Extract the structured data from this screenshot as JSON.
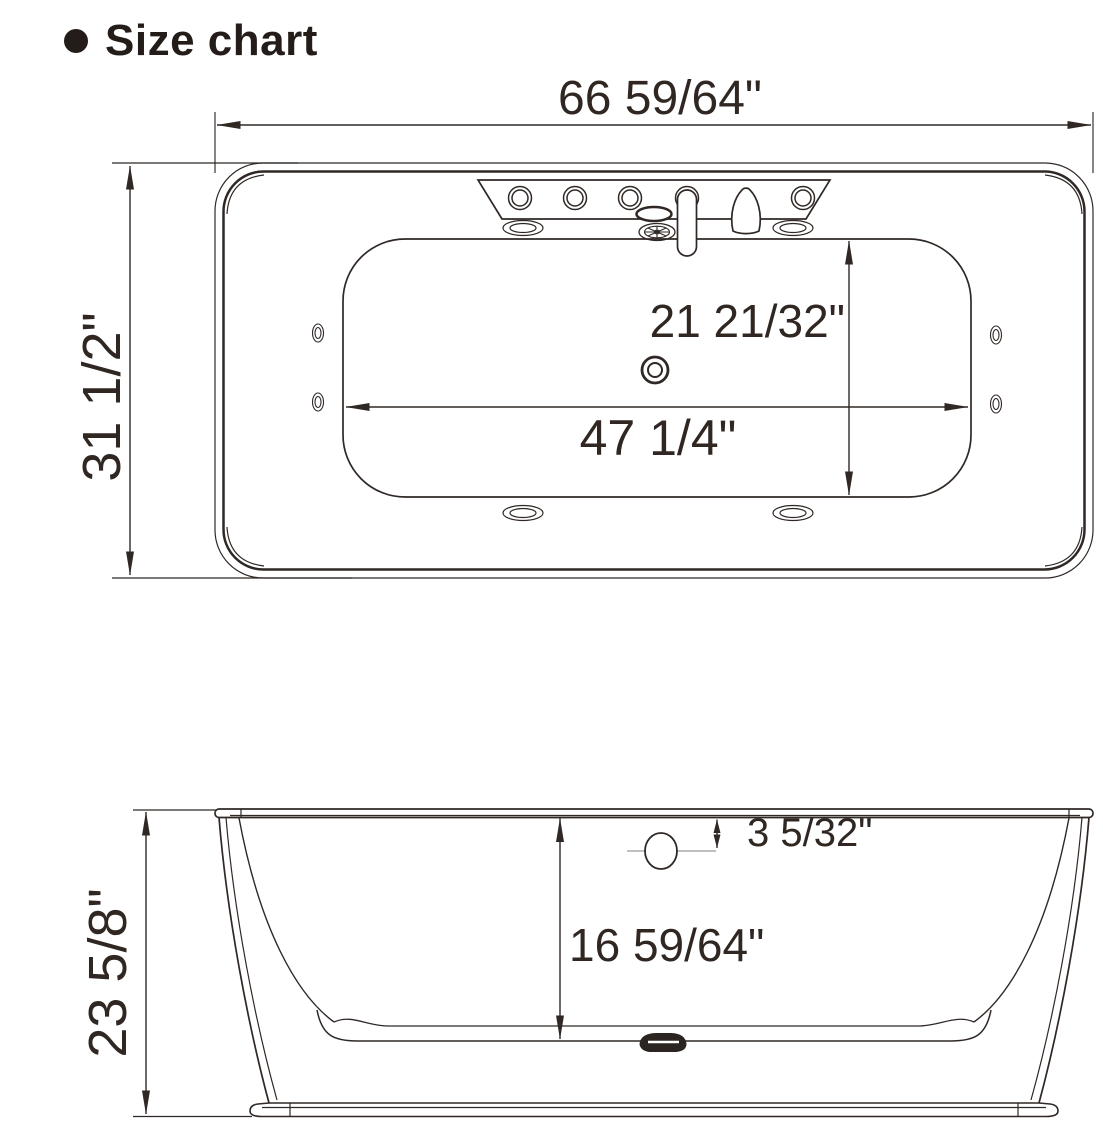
{
  "title": "Size chart",
  "colors": {
    "line": "#2f2825",
    "text": "#302723",
    "muted_line": "#ababab",
    "background": "#ffffff"
  },
  "top_view": {
    "overall_width": "66 59/64\"",
    "overall_depth": "31 1/2\"",
    "basin_length": "47 1/4\"",
    "basin_width": "21 21/32\""
  },
  "side_view": {
    "overall_height": "23 5/8\"",
    "inner_depth": "16 59/64\"",
    "overflow_to_rim": "3 5/32\""
  }
}
